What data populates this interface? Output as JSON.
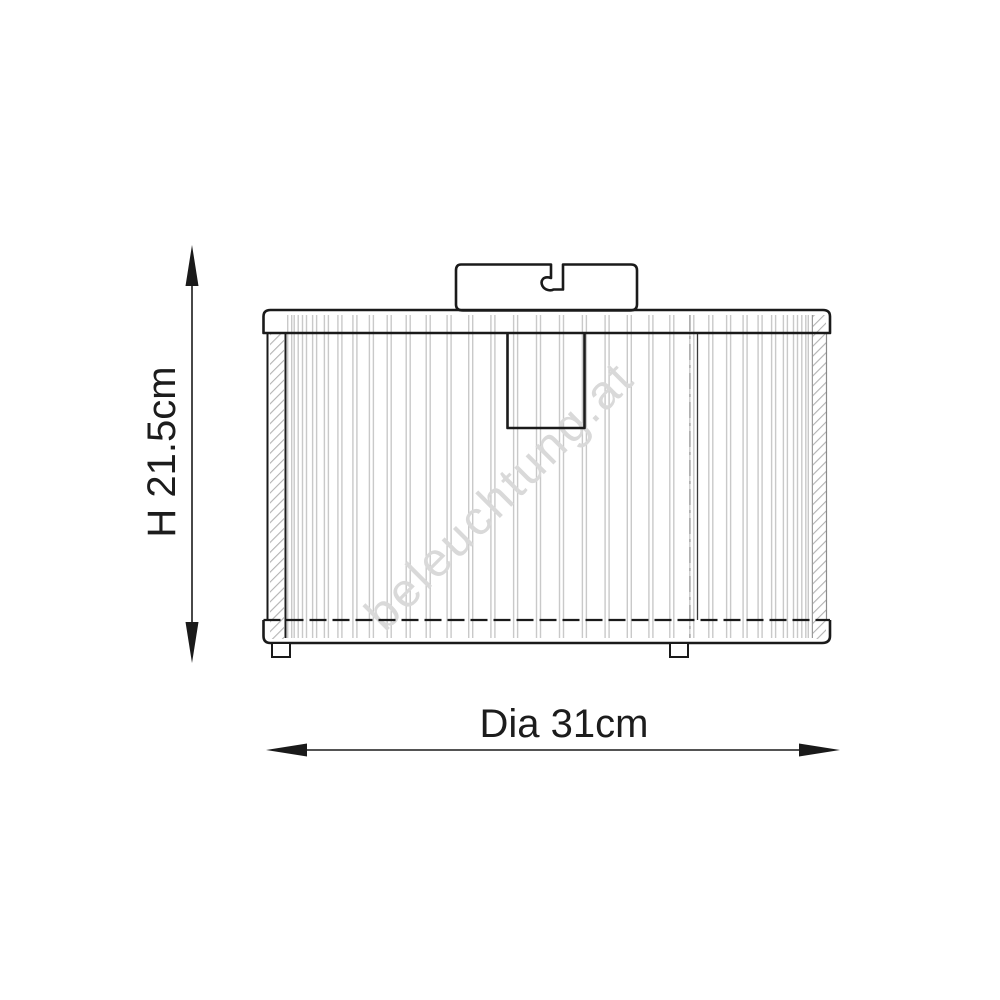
{
  "watermark": {
    "text": "beleuchtung.at",
    "color": "#d9d9d9"
  },
  "dimension_labels": {
    "height": "H 21.5cm",
    "diameter": "Dia 31cm"
  },
  "figure": {
    "line_color": "#1a1a1a",
    "hatch_color": "#b3b3b3",
    "slats": {
      "count": 32,
      "center_x": 550,
      "radius": 268,
      "angle_max": 1.33,
      "y_top": 315,
      "y_bottom": 638,
      "half_gap": 2,
      "color": "#c9c9c9"
    }
  }
}
